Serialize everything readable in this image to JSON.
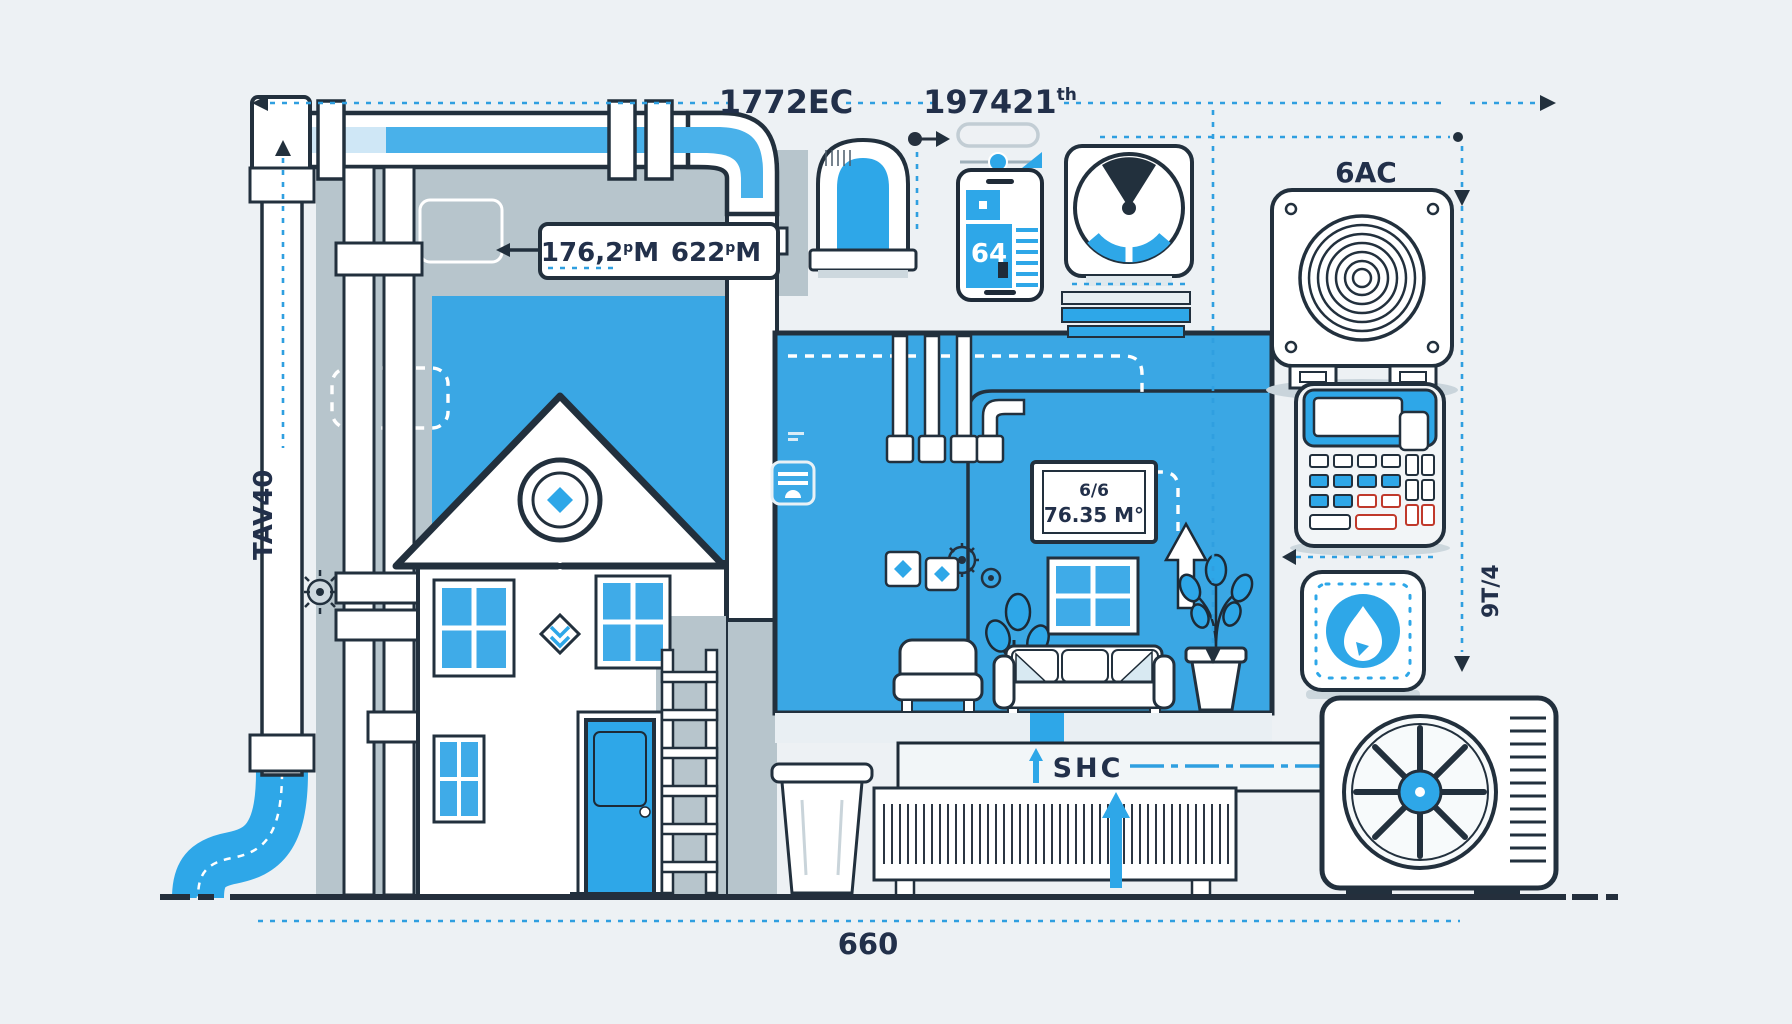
{
  "title": "Home HVAC sizing illustration",
  "colors": {
    "background": "#edf1f4",
    "blue": "#2ea7e8",
    "room_blue": "#3aa7e4",
    "outline": "#22303d",
    "gray_backdrop": "#b7c5cc",
    "dash_blue": "#2f9fe0",
    "shadow": "#c9d4db",
    "text": "#22304a",
    "white": "#ffffff"
  },
  "dim_top": {
    "left_label": "1772EC",
    "right_label": "197421",
    "right_label_sup": "th"
  },
  "duct_label": {
    "left_value": "176,2",
    "left_sup": "p",
    "left_unit": "M",
    "right_value": "622",
    "right_sup": "p",
    "right_unit": "M"
  },
  "side_labels": {
    "left_rotated": "TAV40",
    "right_rotated": "9T/4"
  },
  "ac_unit_label": "6AC",
  "room_sign": {
    "line1": "6/6",
    "line2": "76.35 M°"
  },
  "phone": {
    "screen_value": "64"
  },
  "heater_label": "SHC",
  "dim_bottom": {
    "label": "660"
  }
}
